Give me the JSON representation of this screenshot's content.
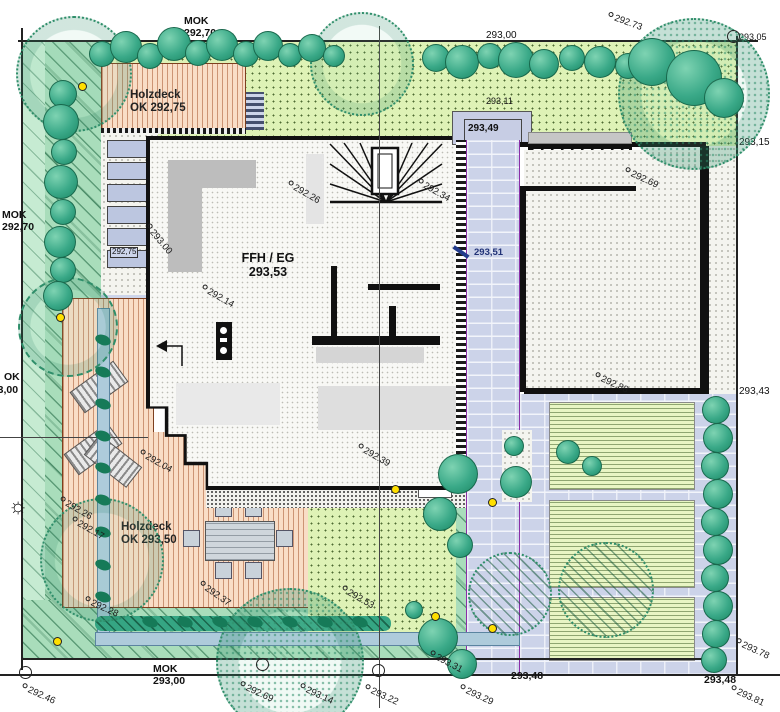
{
  "labels": {
    "mok_top_1": "MOK",
    "mok_top_2": "292,70",
    "mok_left_1": "MOK",
    "mok_left_2": "292,70",
    "ok_left_1": "OK",
    "ok_left_2": "293,00",
    "mok_bottom_1": "MOK",
    "mok_bottom_2": "293,00",
    "lawn_top_level": "293,00",
    "entry_walk_level": "293,11",
    "corner_ne_level": "293,05",
    "right_upper_level": "293,15",
    "right_lower_level": "293,43",
    "bottom_path_level": "293,48",
    "bottom_right_level": "293,48",
    "deck_top_name": "Holzdeck",
    "deck_top_level": "OK 292,75",
    "deck_bottom_name": "Holzdeck",
    "deck_bottom_level": "OK 293,50",
    "building_name": "FFH / EG",
    "building_level": "293,53",
    "entrance_level": "293,49",
    "path_level": "293,51",
    "step_level": "292,75"
  },
  "spot_elevations": [
    {
      "text": "292.73",
      "x": 608,
      "y": 10,
      "rot": 20
    },
    {
      "text": "292.69",
      "x": 625,
      "y": 165,
      "rot": 25
    },
    {
      "text": "292.88",
      "x": 595,
      "y": 370,
      "rot": 25
    },
    {
      "text": "292.26",
      "x": 288,
      "y": 178,
      "rot": 30
    },
    {
      "text": "292.34",
      "x": 418,
      "y": 176,
      "rot": 30
    },
    {
      "text": "292.14",
      "x": 202,
      "y": 282,
      "rot": 30
    },
    {
      "text": "293.00",
      "x": 147,
      "y": 220,
      "rot": 50
    },
    {
      "text": "292.39",
      "x": 358,
      "y": 441,
      "rot": 30
    },
    {
      "text": "292.04",
      "x": 140,
      "y": 447,
      "rot": 30
    },
    {
      "text": "292.26",
      "x": 60,
      "y": 494,
      "rot": 30
    },
    {
      "text": "292.17",
      "x": 72,
      "y": 514,
      "rot": 30
    },
    {
      "text": "292.28",
      "x": 85,
      "y": 594,
      "rot": 25
    },
    {
      "text": "292.37",
      "x": 200,
      "y": 578,
      "rot": 35
    },
    {
      "text": "292.53",
      "x": 342,
      "y": 583,
      "rot": 30
    },
    {
      "text": "293.31",
      "x": 430,
      "y": 648,
      "rot": 28
    },
    {
      "text": "292.46",
      "x": 22,
      "y": 681,
      "rot": 25
    },
    {
      "text": "292.69",
      "x": 240,
      "y": 679,
      "rot": 25
    },
    {
      "text": "293.14",
      "x": 300,
      "y": 681,
      "rot": 25
    },
    {
      "text": "293.22",
      "x": 365,
      "y": 682,
      "rot": 25
    },
    {
      "text": "293.29",
      "x": 460,
      "y": 682,
      "rot": 25
    },
    {
      "text": "293.78",
      "x": 736,
      "y": 636,
      "rot": 25
    },
    {
      "text": "293.81",
      "x": 731,
      "y": 683,
      "rot": 25
    }
  ],
  "vegetation": {
    "trees": [
      {
        "x": 72,
        "y": 72,
        "r": 56,
        "style": "ring"
      },
      {
        "x": 360,
        "y": 62,
        "r": 50,
        "style": "ring"
      },
      {
        "x": 692,
        "y": 92,
        "r": 74,
        "style": "speckle"
      },
      {
        "x": 66,
        "y": 325,
        "r": 48,
        "style": "dash"
      },
      {
        "x": 100,
        "y": 558,
        "r": 60,
        "style": "ring"
      },
      {
        "x": 288,
        "y": 660,
        "r": 72,
        "style": "speckle"
      },
      {
        "x": 604,
        "y": 588,
        "r": 46,
        "style": "hatch"
      },
      {
        "x": 508,
        "y": 592,
        "r": 40,
        "style": "hatch"
      }
    ],
    "shrubs": [
      {
        "x": 102,
        "y": 54,
        "r": 13
      },
      {
        "x": 126,
        "y": 47,
        "r": 16
      },
      {
        "x": 150,
        "y": 56,
        "r": 13
      },
      {
        "x": 174,
        "y": 44,
        "r": 17
      },
      {
        "x": 198,
        "y": 53,
        "r": 13
      },
      {
        "x": 222,
        "y": 45,
        "r": 16
      },
      {
        "x": 246,
        "y": 54,
        "r": 13
      },
      {
        "x": 268,
        "y": 46,
        "r": 15
      },
      {
        "x": 290,
        "y": 55,
        "r": 12
      },
      {
        "x": 312,
        "y": 48,
        "r": 14
      },
      {
        "x": 334,
        "y": 56,
        "r": 11
      },
      {
        "x": 436,
        "y": 58,
        "r": 14
      },
      {
        "x": 462,
        "y": 62,
        "r": 17
      },
      {
        "x": 490,
        "y": 56,
        "r": 13
      },
      {
        "x": 516,
        "y": 60,
        "r": 18
      },
      {
        "x": 544,
        "y": 64,
        "r": 15
      },
      {
        "x": 572,
        "y": 58,
        "r": 13
      },
      {
        "x": 600,
        "y": 62,
        "r": 16
      },
      {
        "x": 628,
        "y": 66,
        "r": 13
      },
      {
        "x": 652,
        "y": 62,
        "r": 24
      },
      {
        "x": 694,
        "y": 78,
        "r": 28
      },
      {
        "x": 724,
        "y": 98,
        "r": 20
      },
      {
        "x": 63,
        "y": 94,
        "r": 14
      },
      {
        "x": 61,
        "y": 122,
        "r": 18
      },
      {
        "x": 64,
        "y": 152,
        "r": 13
      },
      {
        "x": 61,
        "y": 182,
        "r": 17
      },
      {
        "x": 63,
        "y": 212,
        "r": 13
      },
      {
        "x": 60,
        "y": 242,
        "r": 16
      },
      {
        "x": 63,
        "y": 270,
        "r": 13
      },
      {
        "x": 58,
        "y": 296,
        "r": 15
      },
      {
        "x": 716,
        "y": 410,
        "r": 14
      },
      {
        "x": 718,
        "y": 438,
        "r": 15
      },
      {
        "x": 715,
        "y": 466,
        "r": 14
      },
      {
        "x": 718,
        "y": 494,
        "r": 15
      },
      {
        "x": 715,
        "y": 522,
        "r": 14
      },
      {
        "x": 718,
        "y": 550,
        "r": 15
      },
      {
        "x": 715,
        "y": 578,
        "r": 14
      },
      {
        "x": 718,
        "y": 606,
        "r": 15
      },
      {
        "x": 716,
        "y": 634,
        "r": 14
      },
      {
        "x": 714,
        "y": 660,
        "r": 13
      },
      {
        "x": 458,
        "y": 474,
        "r": 20
      },
      {
        "x": 440,
        "y": 514,
        "r": 17
      },
      {
        "x": 460,
        "y": 545,
        "r": 13
      },
      {
        "x": 516,
        "y": 482,
        "r": 16
      },
      {
        "x": 514,
        "y": 446,
        "r": 10
      },
      {
        "x": 568,
        "y": 452,
        "r": 12
      },
      {
        "x": 592,
        "y": 466,
        "r": 10
      },
      {
        "x": 438,
        "y": 638,
        "r": 20
      },
      {
        "x": 462,
        "y": 664,
        "r": 15
      },
      {
        "x": 414,
        "y": 610,
        "r": 9
      }
    ],
    "hedge_plants": [
      {
        "x": 103,
        "y": 340
      },
      {
        "x": 103,
        "y": 372
      },
      {
        "x": 103,
        "y": 404
      },
      {
        "x": 103,
        "y": 436
      },
      {
        "x": 103,
        "y": 468
      },
      {
        "x": 103,
        "y": 500
      },
      {
        "x": 103,
        "y": 532
      },
      {
        "x": 103,
        "y": 565
      },
      {
        "x": 103,
        "y": 597
      },
      {
        "x": 150,
        "y": 622
      },
      {
        "x": 185,
        "y": 622
      },
      {
        "x": 220,
        "y": 622
      },
      {
        "x": 255,
        "y": 622
      },
      {
        "x": 290,
        "y": 622
      },
      {
        "x": 325,
        "y": 622
      },
      {
        "x": 360,
        "y": 622
      }
    ],
    "lights": [
      {
        "x": 82,
        "y": 86
      },
      {
        "x": 60,
        "y": 317
      },
      {
        "x": 57,
        "y": 641
      },
      {
        "x": 395,
        "y": 489
      },
      {
        "x": 435,
        "y": 616
      },
      {
        "x": 492,
        "y": 628
      },
      {
        "x": 492,
        "y": 502
      }
    ]
  },
  "survey_points": [
    {
      "x": 25,
      "y": 672
    },
    {
      "x": 262,
      "y": 664
    },
    {
      "x": 378,
      "y": 670
    },
    {
      "x": 733,
      "y": 36
    }
  ],
  "colors": {
    "lawn": "#def2b6",
    "slope_green": "#a9ddbb",
    "deck_wood": "#f9ddc6",
    "brick_paving": "#ccd3e9",
    "shrub_teal": "#3aa988",
    "wall_black": "#111111",
    "platform_gray": "#c7cde4",
    "water_blue": "#aecbdb",
    "boundary_purple": "#8b2fa8",
    "light_yellow": "#ffdf00"
  }
}
